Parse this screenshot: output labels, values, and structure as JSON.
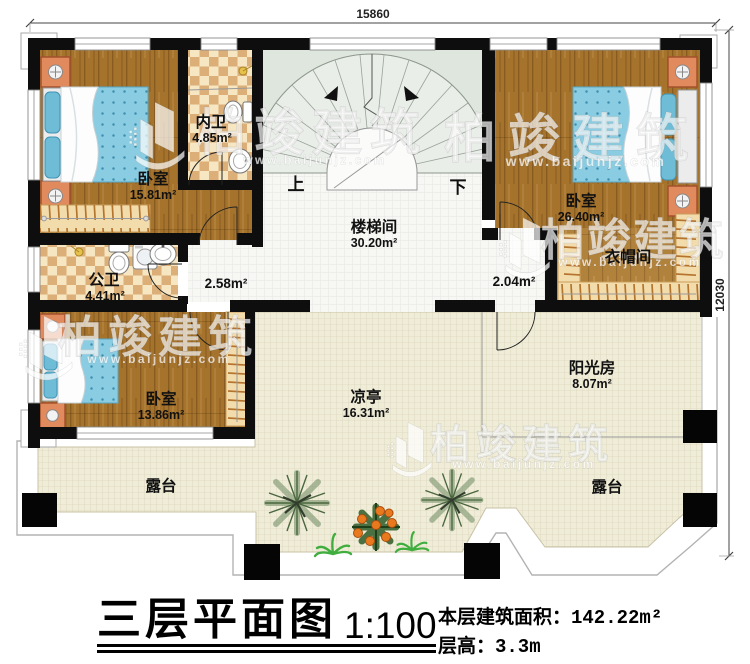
{
  "plan": {
    "dimensions": {
      "top": "15860",
      "right": "12030"
    },
    "stair": {
      "up": "上",
      "down": "下"
    },
    "rooms": {
      "bedroom_tl": {
        "name": "卧室",
        "area": "15.81m²"
      },
      "inner_bath": {
        "name": "内卫",
        "area": "4.85m²"
      },
      "public_bath": {
        "name": "公卫",
        "area": "4.41m²"
      },
      "hall_left": {
        "area": "2.58m²"
      },
      "hall_right": {
        "area": "2.04m²"
      },
      "stairwell": {
        "name": "楼梯间",
        "area": "30.20m²"
      },
      "bedroom_tr": {
        "name": "卧室",
        "area": "26.40m²"
      },
      "cloakroom": {
        "name": "衣帽间"
      },
      "bedroom_bl": {
        "name": "卧室",
        "area": "13.86m²"
      },
      "pavilion": {
        "name": "凉亭",
        "area": "16.31m²"
      },
      "sunroom": {
        "name": "阳光房",
        "area": "8.07m²"
      },
      "terrace_left": {
        "name": "露台"
      },
      "terrace_right": {
        "name": "露台"
      }
    }
  },
  "watermark": {
    "brand": "柏竣建筑",
    "url": "www.baijunjz.com"
  },
  "titlebar": {
    "title": "三层平面图",
    "scale": "1:100",
    "area_text": "本层建筑面积：142.22m²",
    "floor_height_text": "层高：3.3m"
  },
  "colors": {
    "wall": "#0e0e0e",
    "wood_floor": "#a5732c",
    "bath_checker": "#dcaf78",
    "stair_fill": "#e9eee8",
    "terrace_tile": "#efecd8",
    "mattress": "#8acce2",
    "nightstand": "#e08a5d",
    "column": "#050505"
  }
}
